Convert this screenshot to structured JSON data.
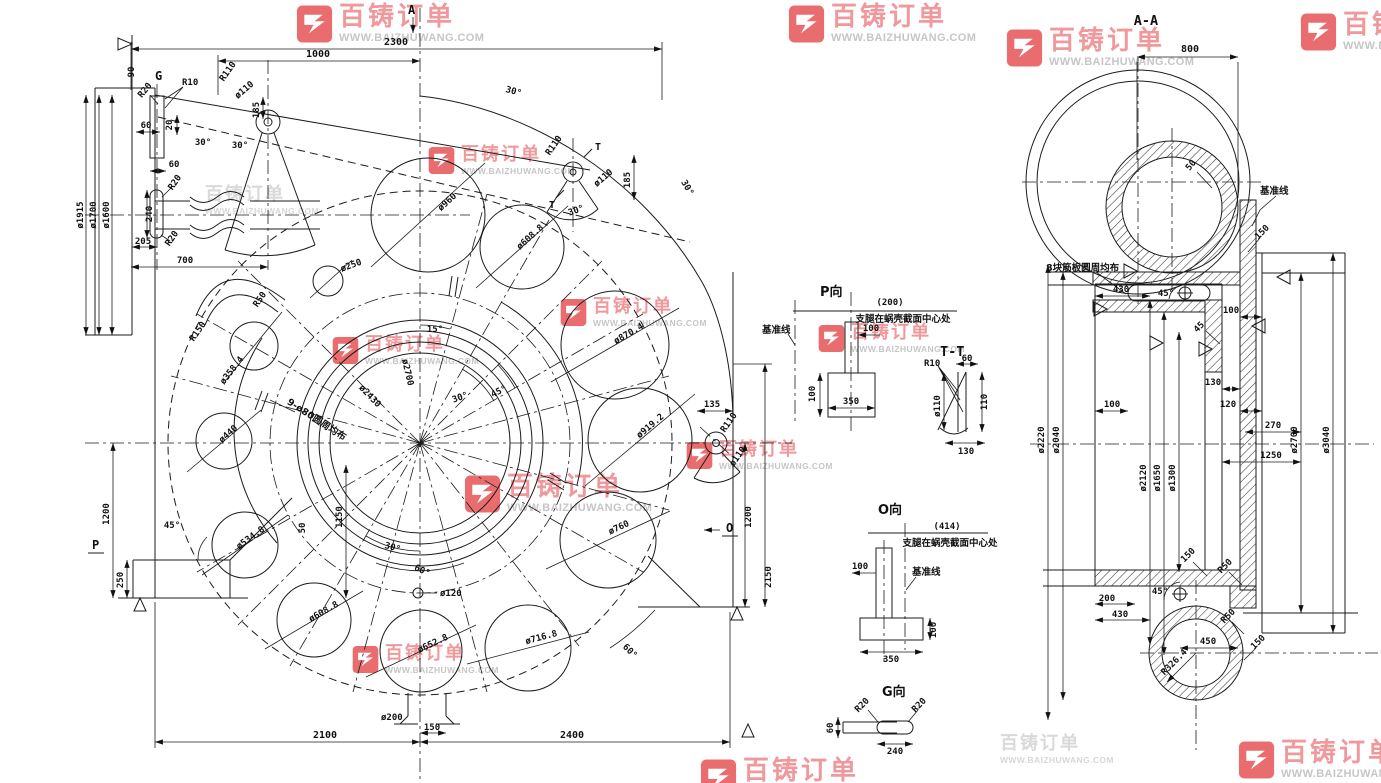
{
  "watermark": {
    "brand": "百铸订单",
    "url": "WWW.BAIZHUWANG.COM"
  },
  "front": {
    "marker_top": "A",
    "dim_2300": "2300",
    "dim_1000": "1000",
    "dim_90": "90",
    "label_g": "G",
    "r10": "R10",
    "r20_top": "R20",
    "r110_a": "R110",
    "d110_a": "ø110",
    "dim_185a": "185",
    "dim_60a": "60",
    "dim_20": "20",
    "ang_30a": "30°",
    "ang_30b": "30°",
    "dim_60b": "60",
    "r20_mid": "R20",
    "dim_240": "240",
    "r20_low": "R20",
    "dim_205": "205",
    "dim_700": "700",
    "dia_1915": "ø1915",
    "dia_1700": "ø1700",
    "dia_1600": "ø1600",
    "r150": "R150",
    "r50": "R50",
    "d250": "ø250",
    "t_r110": "R110",
    "t_mark1": "T",
    "t_mark2": "T",
    "t_d110": "ø110",
    "t_dim185": "185",
    "t_ang30": "30°",
    "arc_30a": "30°",
    "arc_30b": "30°",
    "holes": [
      {
        "label": "ø960"
      },
      {
        "label": "ø608.8"
      },
      {
        "label": "ø870.4"
      },
      {
        "label": "ø919.2"
      },
      {
        "label": "ø760"
      },
      {
        "label": "ø716.8"
      },
      {
        "label": "ø652.8"
      },
      {
        "label": "ø608.8"
      },
      {
        "label": "ø534.8"
      },
      {
        "label": "ø440"
      },
      {
        "label": "ø358.4"
      }
    ],
    "bolt_note": "9-ø80圆周均布",
    "dia_2430": "ø2430",
    "dia_2700": "ø2700",
    "ang_15": "15°",
    "ang_30c": "30°",
    "ang_45c": "45°",
    "ang_30d": "30°",
    "ang_60d": "60°",
    "ang_60e": "60°",
    "ang_45l": "45°",
    "dim_1150": "1150",
    "dim_50": "50",
    "d120": "ø120",
    "d200": "ø200",
    "dim_150": "150",
    "dim_2100": "2100",
    "dim_2400": "2400",
    "dim_135": "135",
    "o_r110": "R110",
    "o_d110": "ø110",
    "marker_o": "O",
    "dim_1200r": "1200",
    "dim_2150": "2150",
    "marker_p": "P",
    "dim_1200l": "1200",
    "dim_250": "250"
  },
  "view_p": {
    "title": "P向",
    "paren": "(200)",
    "note": "支腿在蜗壳截面中心处",
    "datum": "基准线",
    "dim_100a": "100",
    "dim_100b": "100",
    "dim_350": "350"
  },
  "view_tt": {
    "title": "T-T",
    "r10": "R10",
    "dim_60": "60",
    "d110": "ø110",
    "dim_110": "110",
    "dim_130": "130"
  },
  "view_o": {
    "title": "O向",
    "paren": "(414)",
    "note": "支腿在蜗壳截面中心处",
    "datum": "基准线",
    "dim_100a": "100",
    "dim_100b": "100",
    "dim_350": "350"
  },
  "view_g": {
    "title": "G向",
    "r20a": "R20",
    "r20b": "R20",
    "dim_60": "60",
    "dim_240": "240"
  },
  "aa": {
    "title": "A-A",
    "dim_800": "800",
    "thk_50": "50",
    "datum": "基准线",
    "step_150": "150",
    "rib_note": "8块筋板圆周均布",
    "dim_430a": "430",
    "ang_45a": "45°",
    "dim_100r": "100",
    "dim_45": "45",
    "dim_130": "130",
    "dim_120": "120",
    "dim_100l": "100",
    "dim_270": "270",
    "dim_1250": "1250",
    "dia_2220": "ø2220",
    "dia_2040": "ø2040",
    "dia_2120": "ø2120",
    "dia_1650": "ø1650",
    "dia_1300": "ø1300",
    "dia_2700": "ø2700",
    "dia_3040": "ø3040",
    "lbl_150a": "150",
    "lbl_r50a": "R50",
    "lbl_r50b": "R50",
    "lbl_150b": "150",
    "dim_200": "200",
    "dim_430b": "430",
    "ang_45b": "45°",
    "dim_450": "450",
    "r326": "R326.4"
  }
}
